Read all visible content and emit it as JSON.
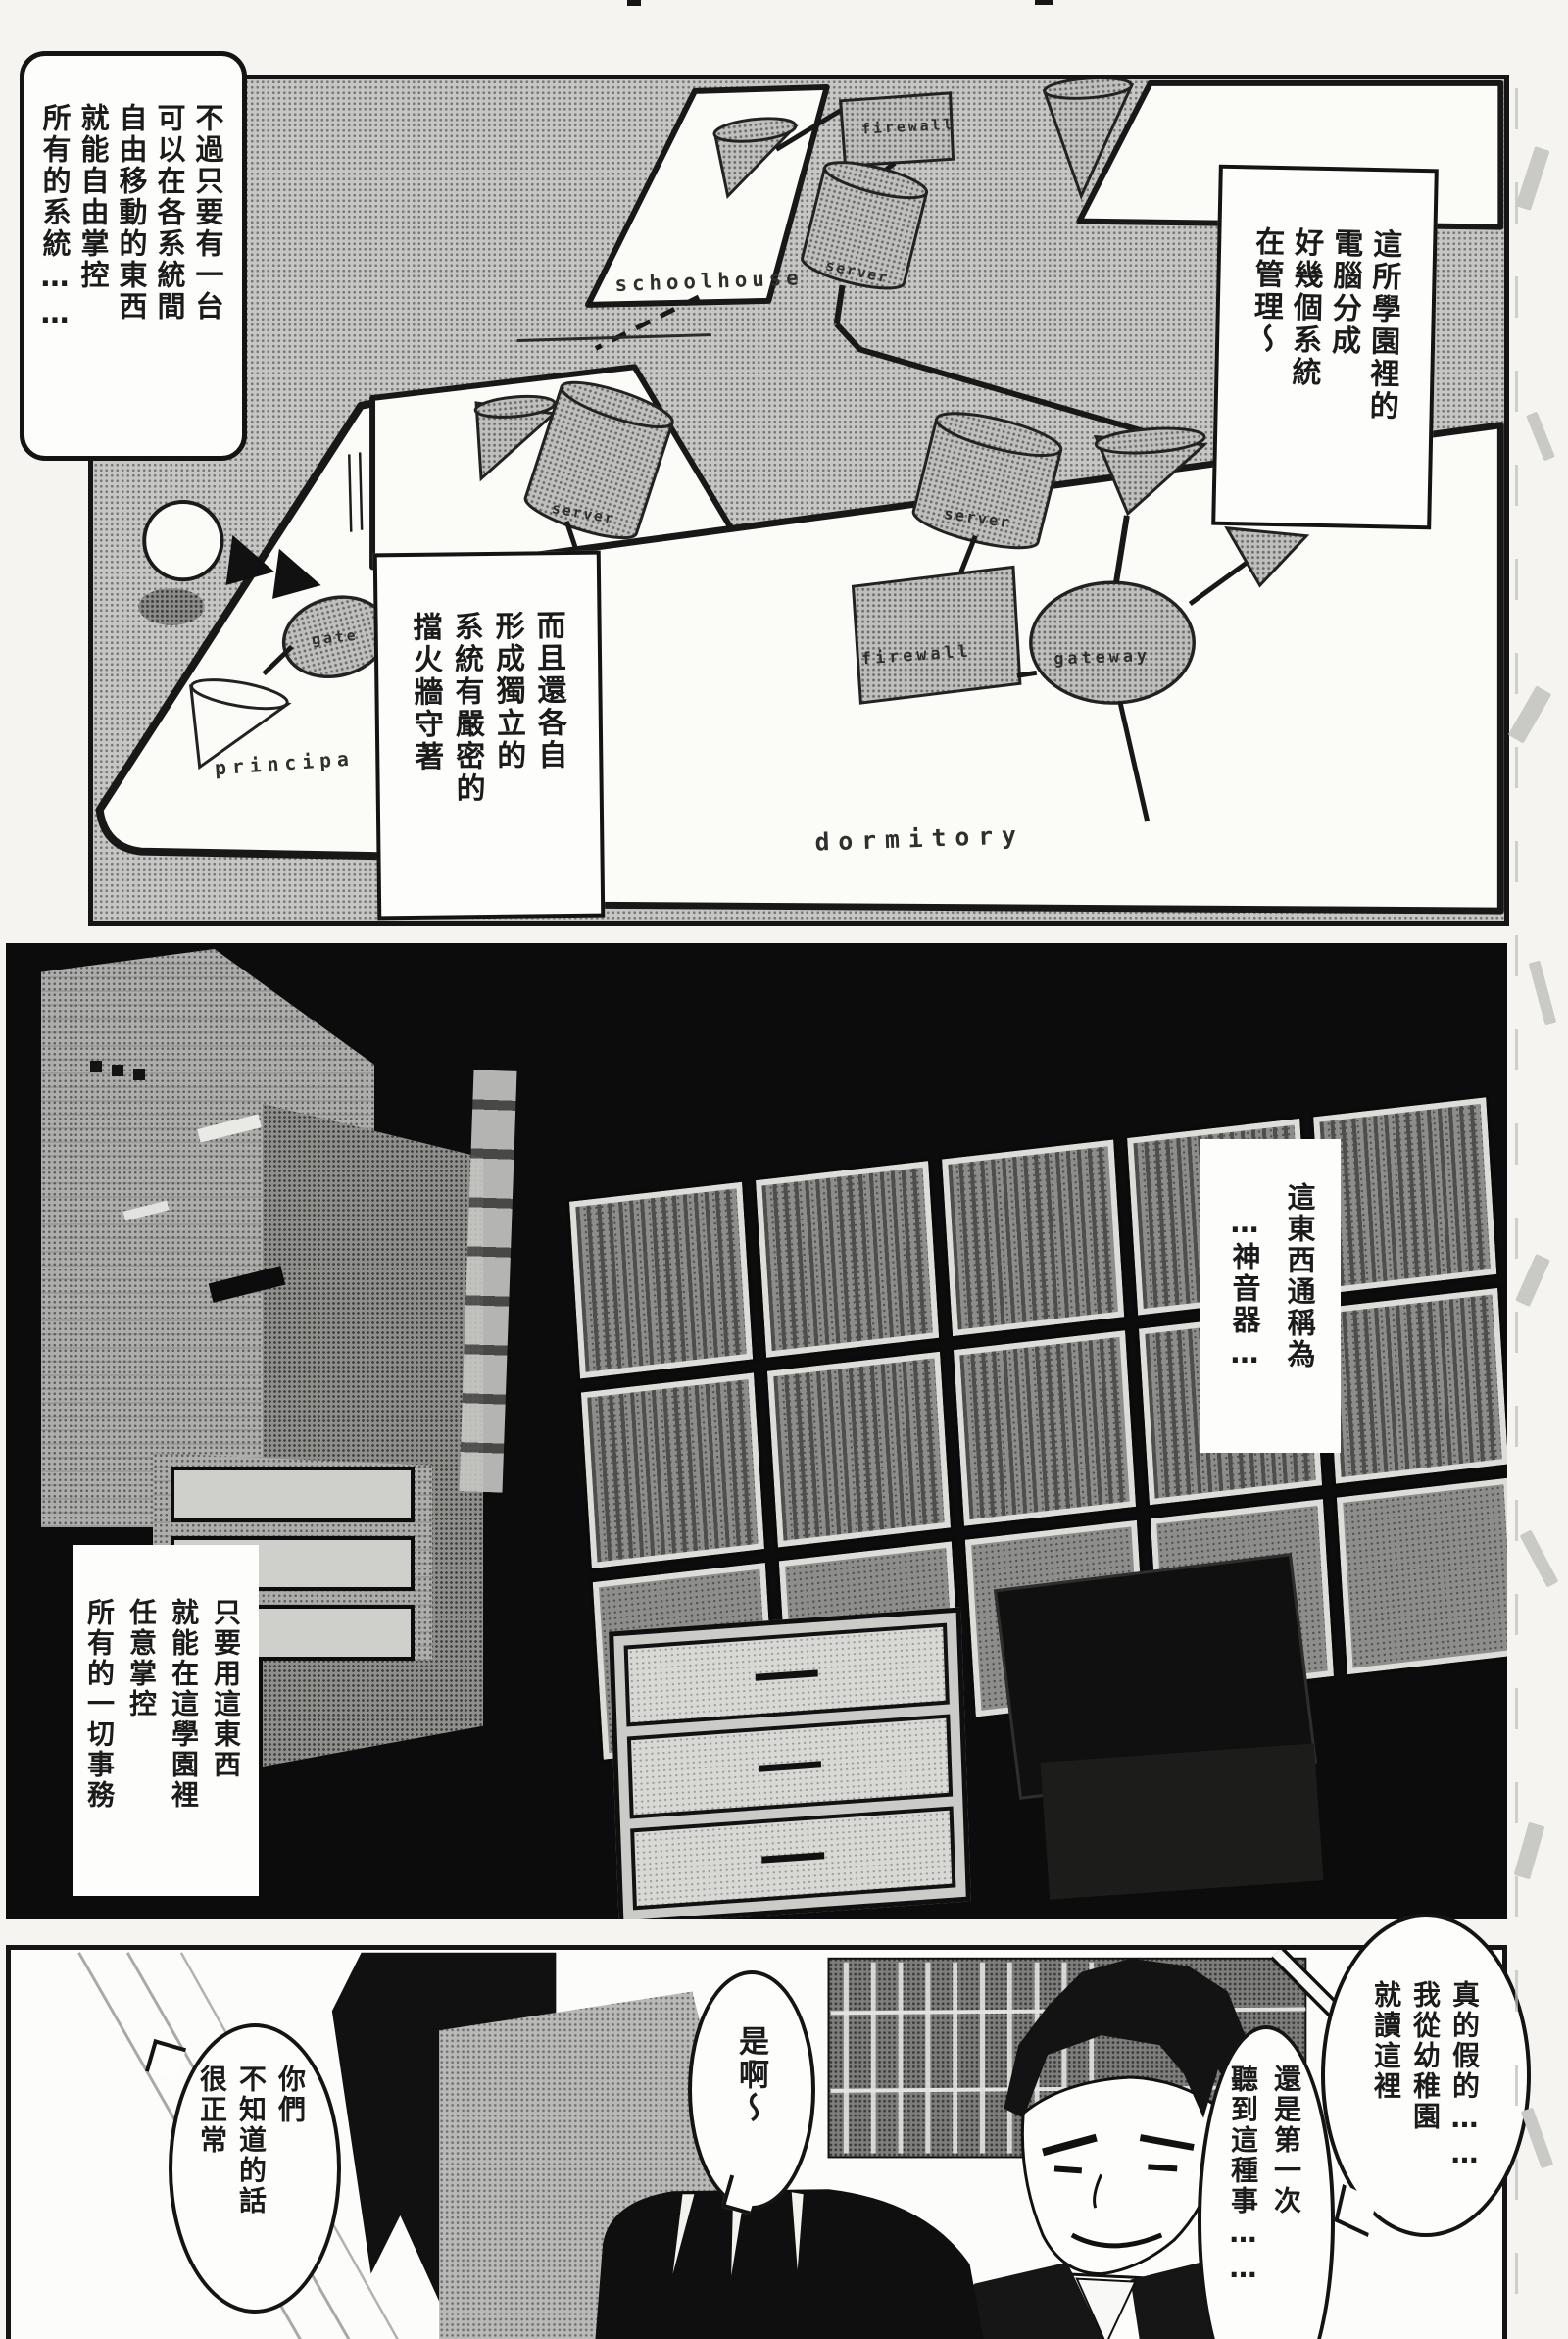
{
  "colors": {
    "paper": "#f5f4f1",
    "ink": "#151515",
    "tone_gray": "#c6c6c4",
    "panel_black": "#0c0c0c",
    "bubble_white": "#fdfdfb"
  },
  "panel1": {
    "bubble_top_left": [
      "不過只要有一台",
      "可以在各系統間",
      "自由移動的東西",
      "就能自由掌控",
      "所有的系統……"
    ],
    "bubble_top_right": [
      "這所學園裡的",
      "電腦分成",
      "好幾個系統",
      "在管理～"
    ],
    "box_firewall": [
      "而且還各自",
      "形成獨立的",
      "系統有嚴密的",
      "擋火牆守著"
    ],
    "diagram": {
      "schoolhouse_label": "schoolhouse",
      "schoolhouse_firewall": "firewall",
      "schoolhouse_server": "server",
      "principal_label": "principa",
      "principal_gateway": "gate",
      "mid_server": "server",
      "dorm_server": "server",
      "dorm_firewall": "firewall",
      "dorm_gateway": "gateway",
      "dormitory_label": "dormitory"
    }
  },
  "panel2": {
    "box_device": [
      "這東西通稱為",
      "…神音器…"
    ],
    "box_control": [
      "只要用這東西",
      "就能在這學園裡",
      "任意掌控",
      "所有的一切事務"
    ]
  },
  "panel3": {
    "bubble_really": [
      "真的假的……",
      "我從幼稚園",
      "就讀這裡"
    ],
    "bubble_first_time": [
      "還是第一次",
      "聽到這種事……"
    ],
    "bubble_yeah": [
      "是啊～"
    ],
    "bubble_normal": [
      "你們",
      "不知道的話",
      "很正常"
    ]
  }
}
